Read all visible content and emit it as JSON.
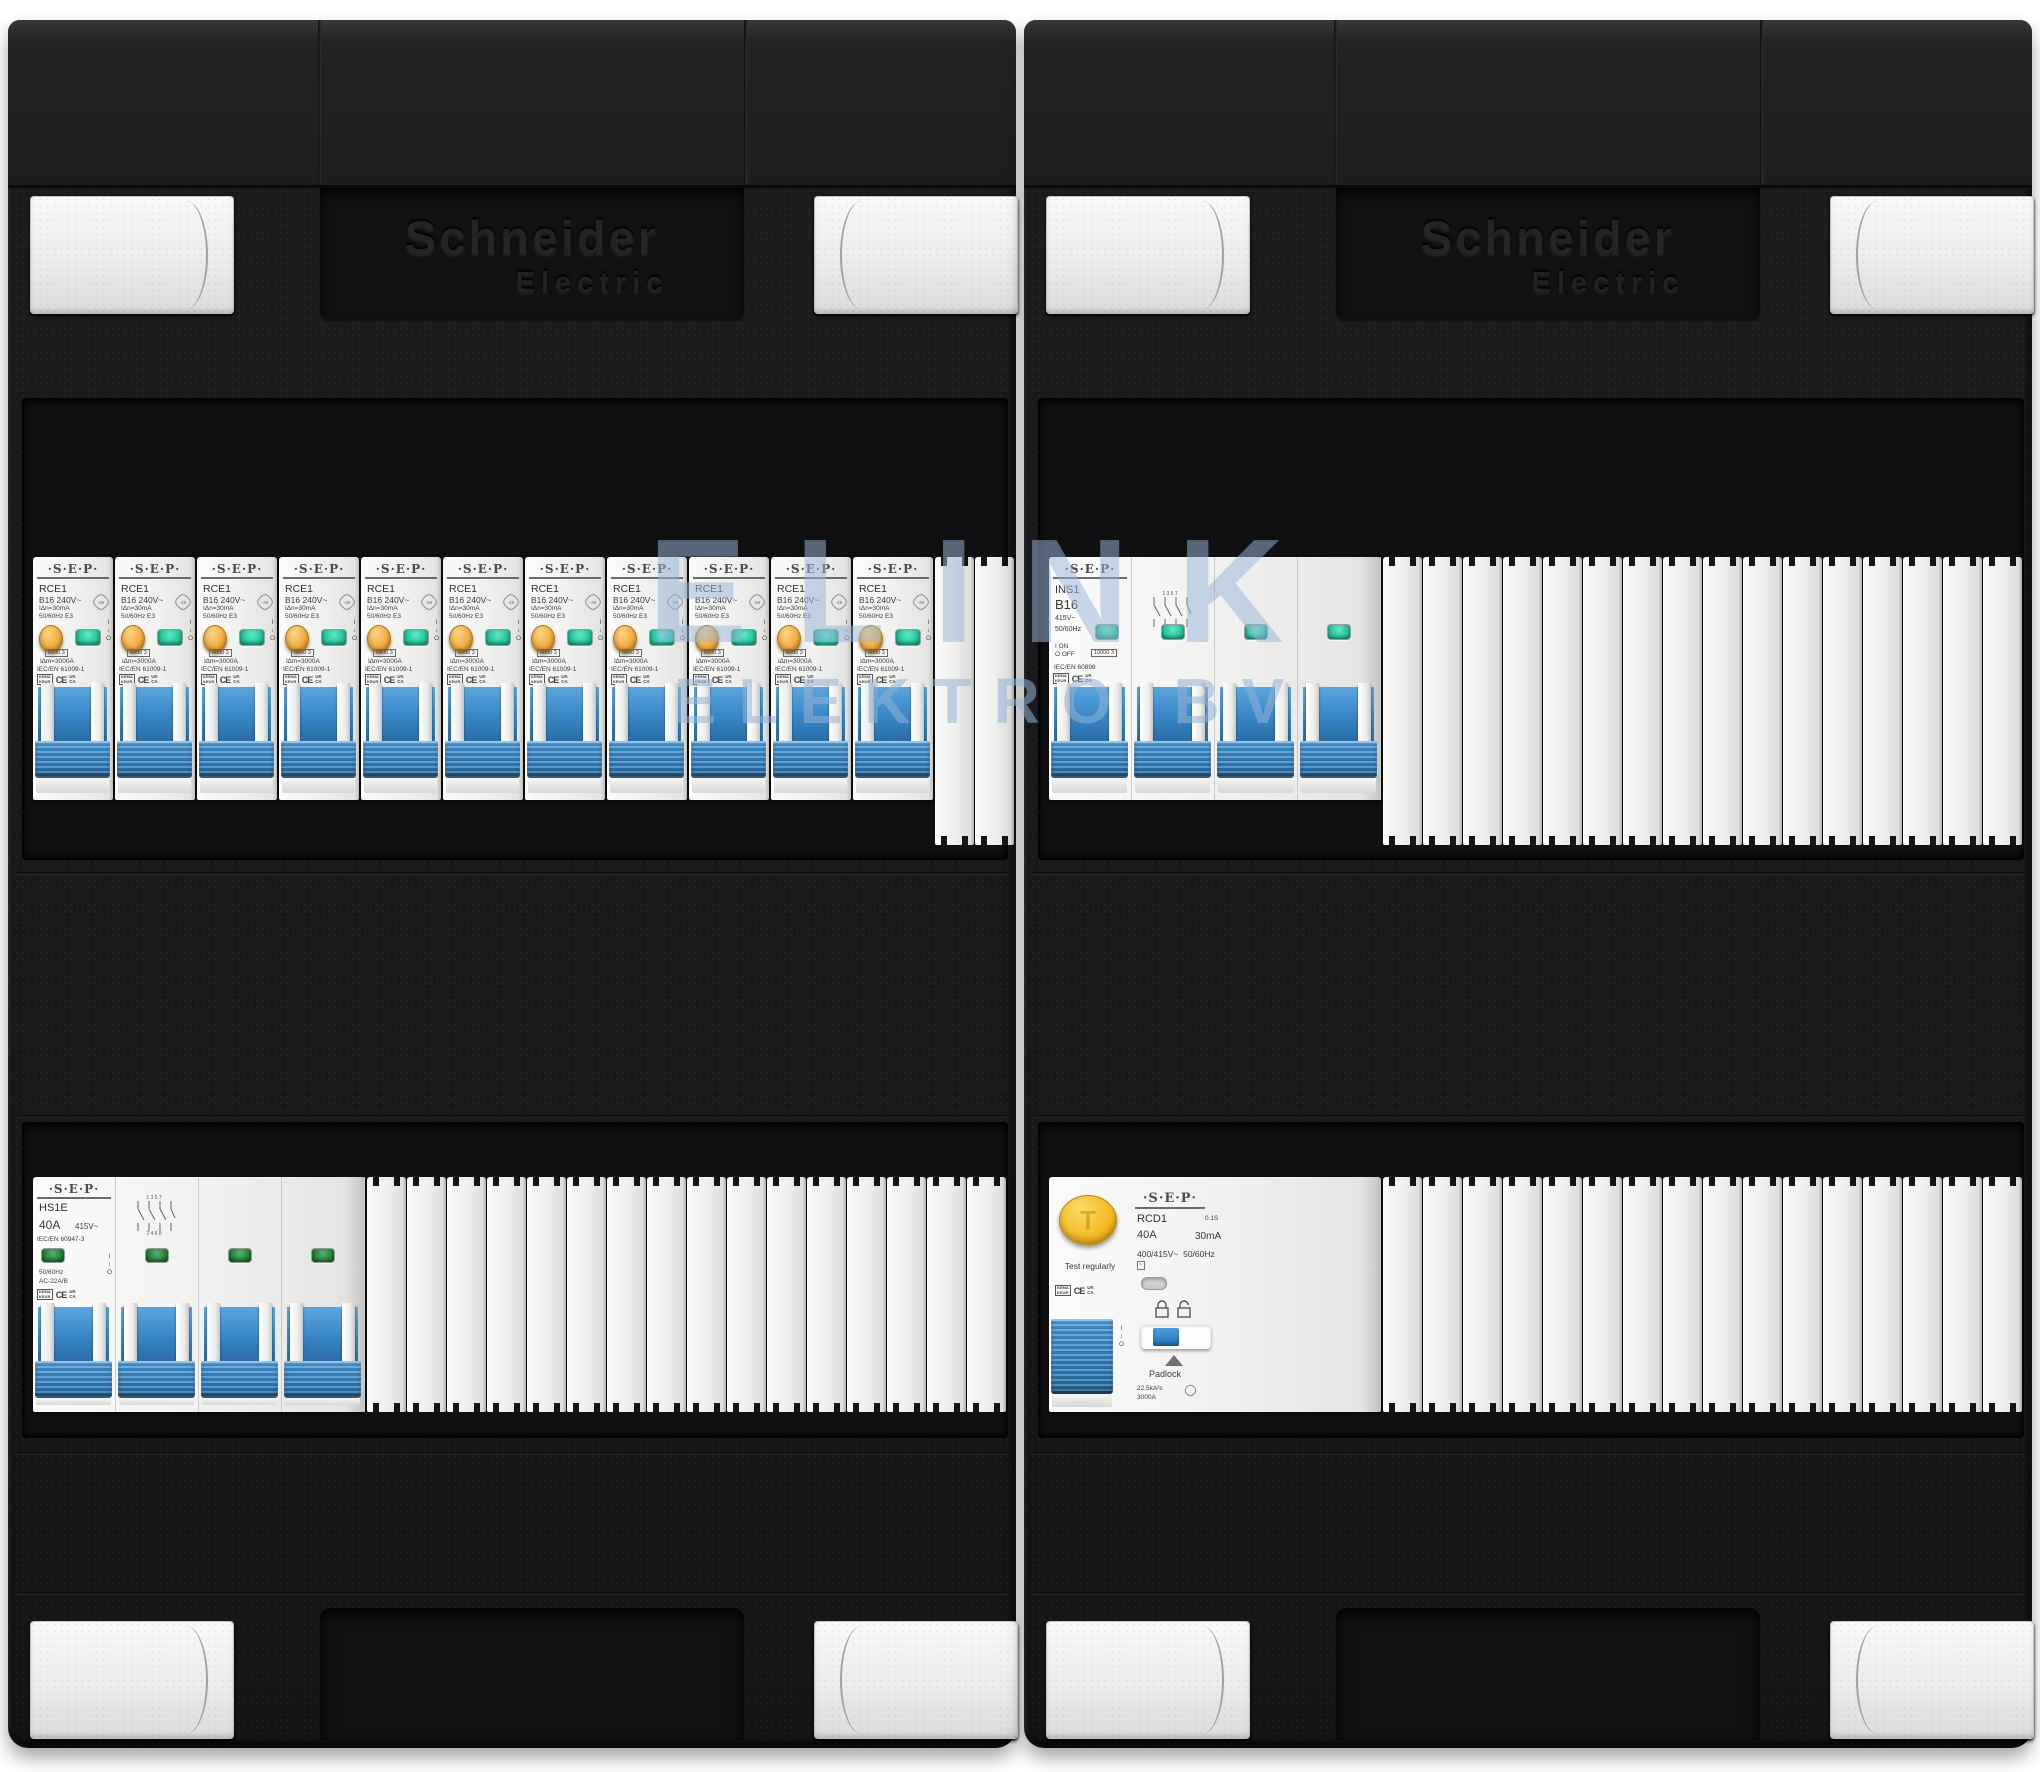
{
  "watermark": {
    "line1": "ELINK",
    "line2": "ELEKTRO BV"
  },
  "brand": {
    "line1": "Schneider",
    "line2": "Electric"
  },
  "io": {
    "on": "I",
    "arrows": "↕",
    "off": "O"
  },
  "marks": {
    "kema_top": "KEMA",
    "kema_bottom": "KEUR",
    "ce": "CE",
    "ukca_top": "UK",
    "ukca_bottom": "CA"
  },
  "diagram": {
    "top": "1 3 5 7",
    "bottom": "2 4 6 8"
  },
  "counts": {
    "rce1_breakers": 11,
    "row1_left_fillers": 2,
    "row1_right_fillers": 16,
    "row2_left_fillers": 16,
    "row2_right_fillers": 16,
    "ins1_plain_poles": 2,
    "hs1e_plain_poles": 2
  },
  "rce1": {
    "brand": "·S·E·P·",
    "model": "RCE1",
    "rating": "B16  240V~",
    "cold_rating": "-25",
    "idn": "IΔn=30mA",
    "freq_class": "50/60Hz  E3",
    "breaking": "6000 3",
    "im": "I∆m=3000A",
    "standard": "IEC/EN 61009-1"
  },
  "ins1": {
    "brand": "·S·E·P·",
    "model": "INS1",
    "rating": "B16",
    "voltage": "415V~",
    "freq": "50/60Hz",
    "on_label": "I ON",
    "off_label": "O OFF",
    "breaking": "10000 3",
    "standard": "IEC/EN 60898"
  },
  "hs1e": {
    "brand": "·S·E·P·",
    "model": "HS1E",
    "amps": "40A",
    "voltage": "415V~",
    "standard": "IEC/EN 60947-3",
    "freq": "50/60Hz",
    "utilization": "AC-22A/B"
  },
  "rcd1": {
    "brand": "·S·E·P·",
    "model": "RCD1",
    "delay": "0.1S",
    "amps": "40A",
    "idn": "30mA",
    "voltage": "400/415V~",
    "freq": "50/60Hz",
    "symbol": "~",
    "test_label": "Test regularly",
    "padlock_label": "Padlock",
    "i2t": "22.5kA²s",
    "inc": "3000A"
  }
}
